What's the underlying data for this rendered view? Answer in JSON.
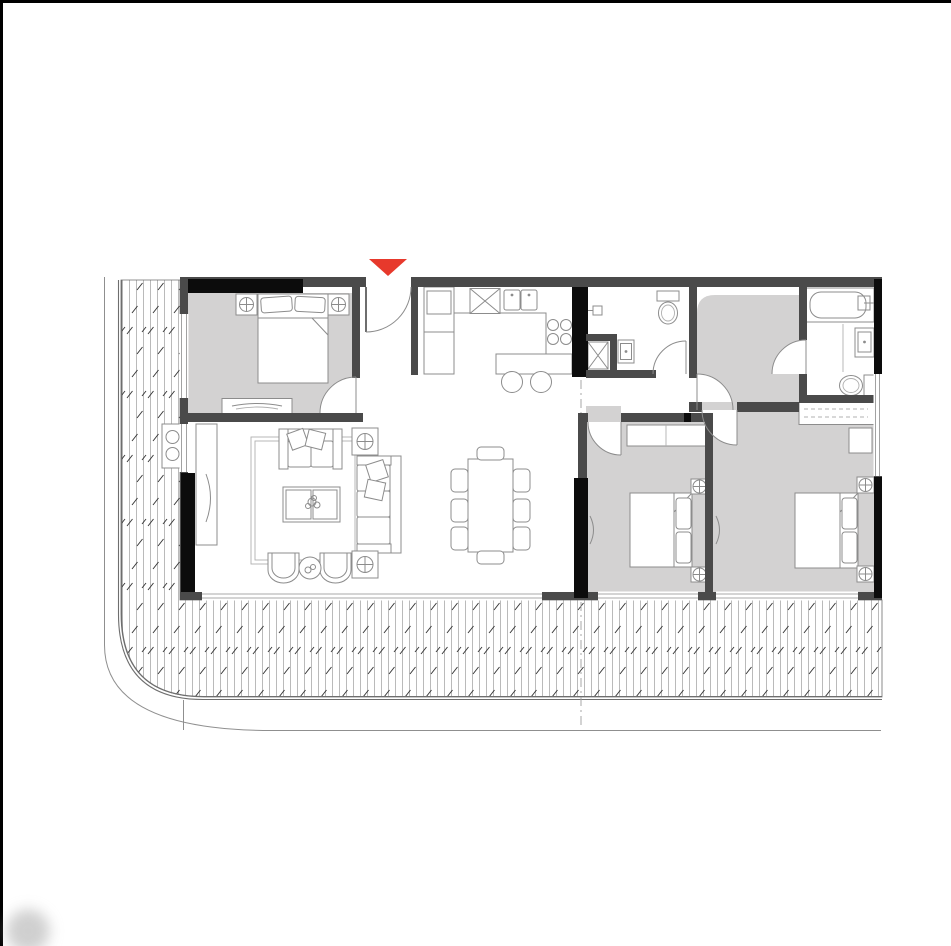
{
  "colors": {
    "page-bg": "#ffffff",
    "page-border": "#000000",
    "wall": "#4a4a4a",
    "wall-black": "#0c0c0c",
    "carpet": "#d3d2d2",
    "line": "#8c8c8c",
    "line-light": "#b0b0b0",
    "window-line": "#8c8c8c",
    "deck-line": "#b3b3b3",
    "deck-tick": "#383838",
    "slab-edge": "#6e6e6e",
    "property-line": "#8f8f8f",
    "centerline": "#9e9e9e",
    "entrance-marker": "#e7392c",
    "watermark": "#a9a9a9"
  },
  "symbols": {
    "entrance-marker": "filled-triangle-pointing-down",
    "table-lamp": "circle-with-crosshair",
    "shower": "square-with-x-diagonals",
    "cooktop": "four-burner-circles",
    "kitchen-sink-unit": "square-with-x",
    "double-basin": "two-squares-with-faucet-dots",
    "bar-stool": "circle",
    "wardrobe-rail": "dashed-lines-in-rectangle",
    "door-swing": "quarter-circle-arc",
    "deck-hatch": "vertical-lines-with-diagonal-ticks",
    "rug": "double-line-rectangle",
    "plant": "scribble-circle-cluster"
  }
}
